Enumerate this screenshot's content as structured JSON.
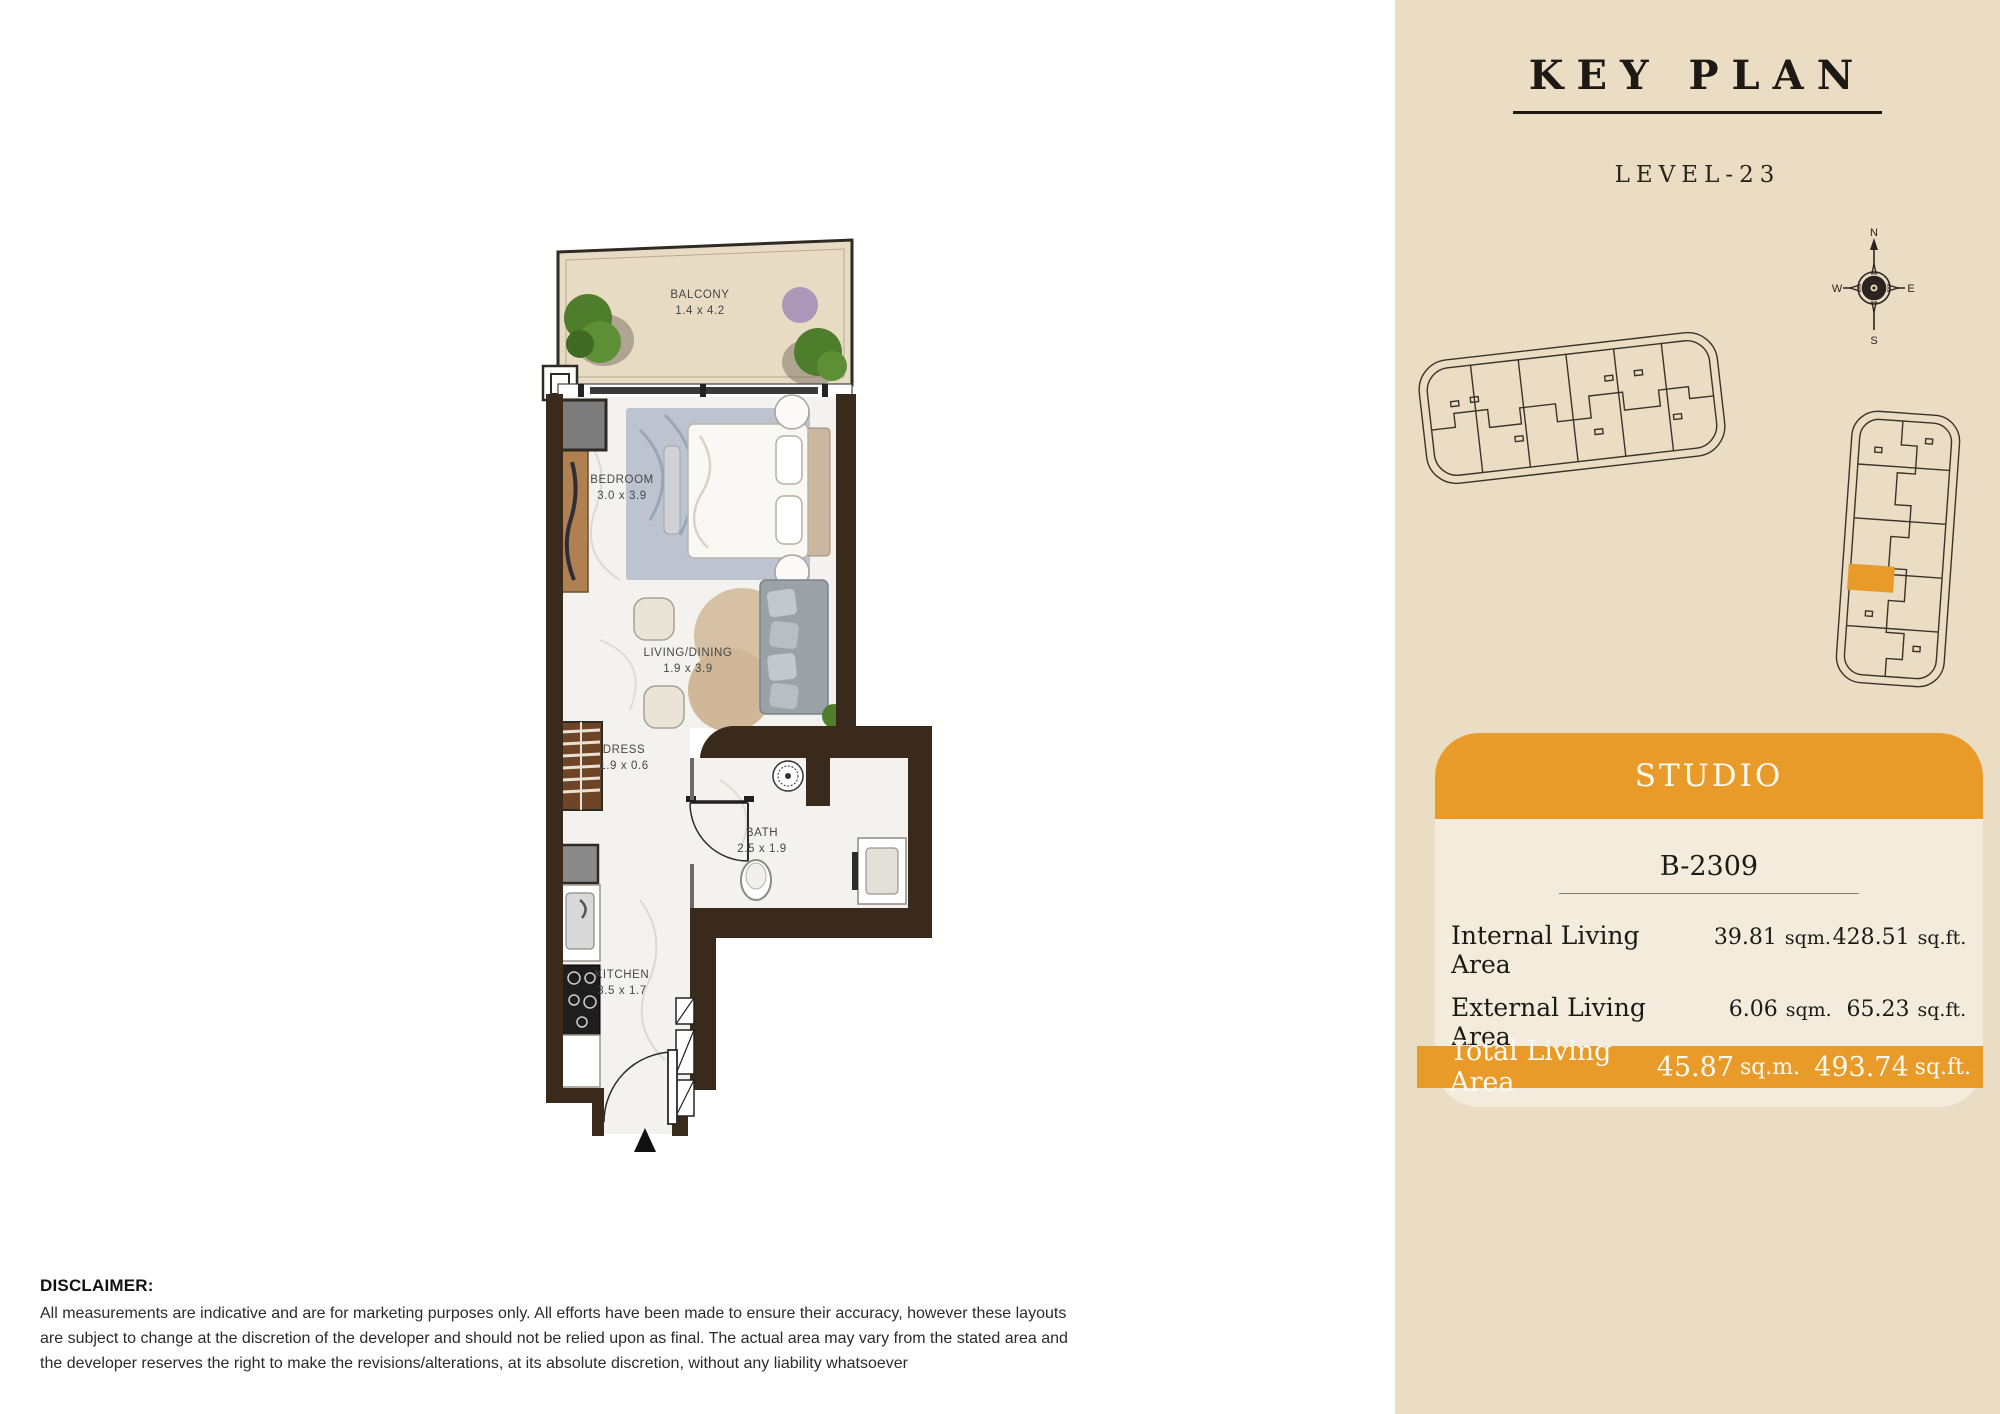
{
  "floor_plan": {
    "rooms": [
      {
        "name": "BALCONY",
        "dims": "1.4 x 4.2"
      },
      {
        "name": "BEDROOM",
        "dims": "3.0 x 3.9"
      },
      {
        "name": "LIVING/DINING",
        "dims": "1.9 x 3.9"
      },
      {
        "name": "DRESS",
        "dims": "1.9 x 0.6"
      },
      {
        "name": "BATH",
        "dims": "2.5 x 1.9"
      },
      {
        "name": "KITCHEN",
        "dims": "3.5 x 1.7"
      }
    ]
  },
  "key_plan": {
    "title": "KEY PLAN",
    "level": "LEVEL-23",
    "compass": {
      "n": "N",
      "e": "E",
      "s": "S",
      "w": "W"
    }
  },
  "unit_card": {
    "type": "STUDIO",
    "unit_number": "B-2309",
    "rows": [
      {
        "label": "Internal Living Area",
        "sqm": "39.81",
        "sqm_unit": "sqm.",
        "sqft": "428.51",
        "sqft_unit": "sq.ft."
      },
      {
        "label": "External Living Area",
        "sqm": "6.06",
        "sqm_unit": "sqm.",
        "sqft": "65.23",
        "sqft_unit": "sq.ft."
      }
    ],
    "total": {
      "label": "Total Living Area",
      "sqm": "45.87",
      "sqm_unit": "sq.m.",
      "sqft": "493.74",
      "sqft_unit": "sq.ft."
    }
  },
  "disclaimer": {
    "title": "DISCLAIMER:",
    "body": "All measurements are indicative and are for marketing purposes only. All efforts have been made to ensure their accuracy, however these layouts are subject to change at the discretion of the developer and should not be relied upon as final. The actual area may vary from the stated area and the developer reserves the right to make the revisions/alterations, at its absolute discretion, without any liability whatsoever"
  },
  "colors": {
    "accent_orange": "#E89B28",
    "panel_background": "#EBDDC3",
    "card_background": "#F3ECDD",
    "wall_brown": "#3A2A1C",
    "balcony_floor": "#E8DBC4"
  }
}
